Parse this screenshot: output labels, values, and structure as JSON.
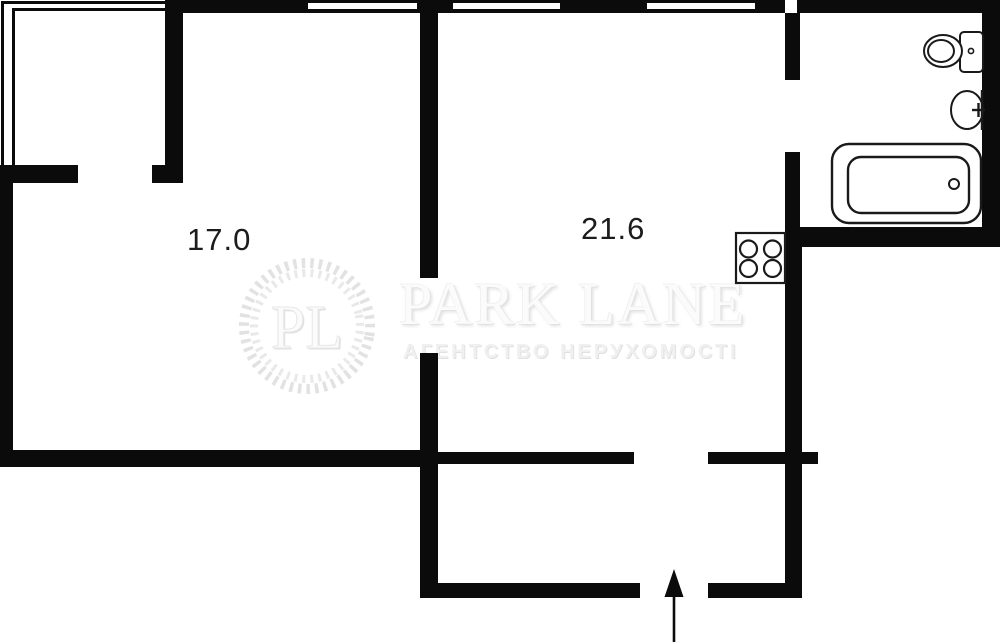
{
  "plan_title": "apartment-floor-plan",
  "rooms": {
    "room_left": {
      "label": "17.0"
    },
    "room_right": {
      "label": "21.6"
    }
  },
  "watermark": {
    "monogram": "PL",
    "brand": "PARK LANE",
    "tagline": "АГЕНТСТВО НЕРУХОМОСТІ"
  },
  "fixtures": {
    "toilet": "toilet",
    "sink": "sink",
    "bathtub": "bathtub",
    "stove": "stove-4-burners",
    "entrance": "entrance-arrow"
  },
  "colors": {
    "wall": "#0b0b0b",
    "background": "#ffffff",
    "label_text": "#1c1c1c",
    "watermark": "#e5e5e5"
  }
}
